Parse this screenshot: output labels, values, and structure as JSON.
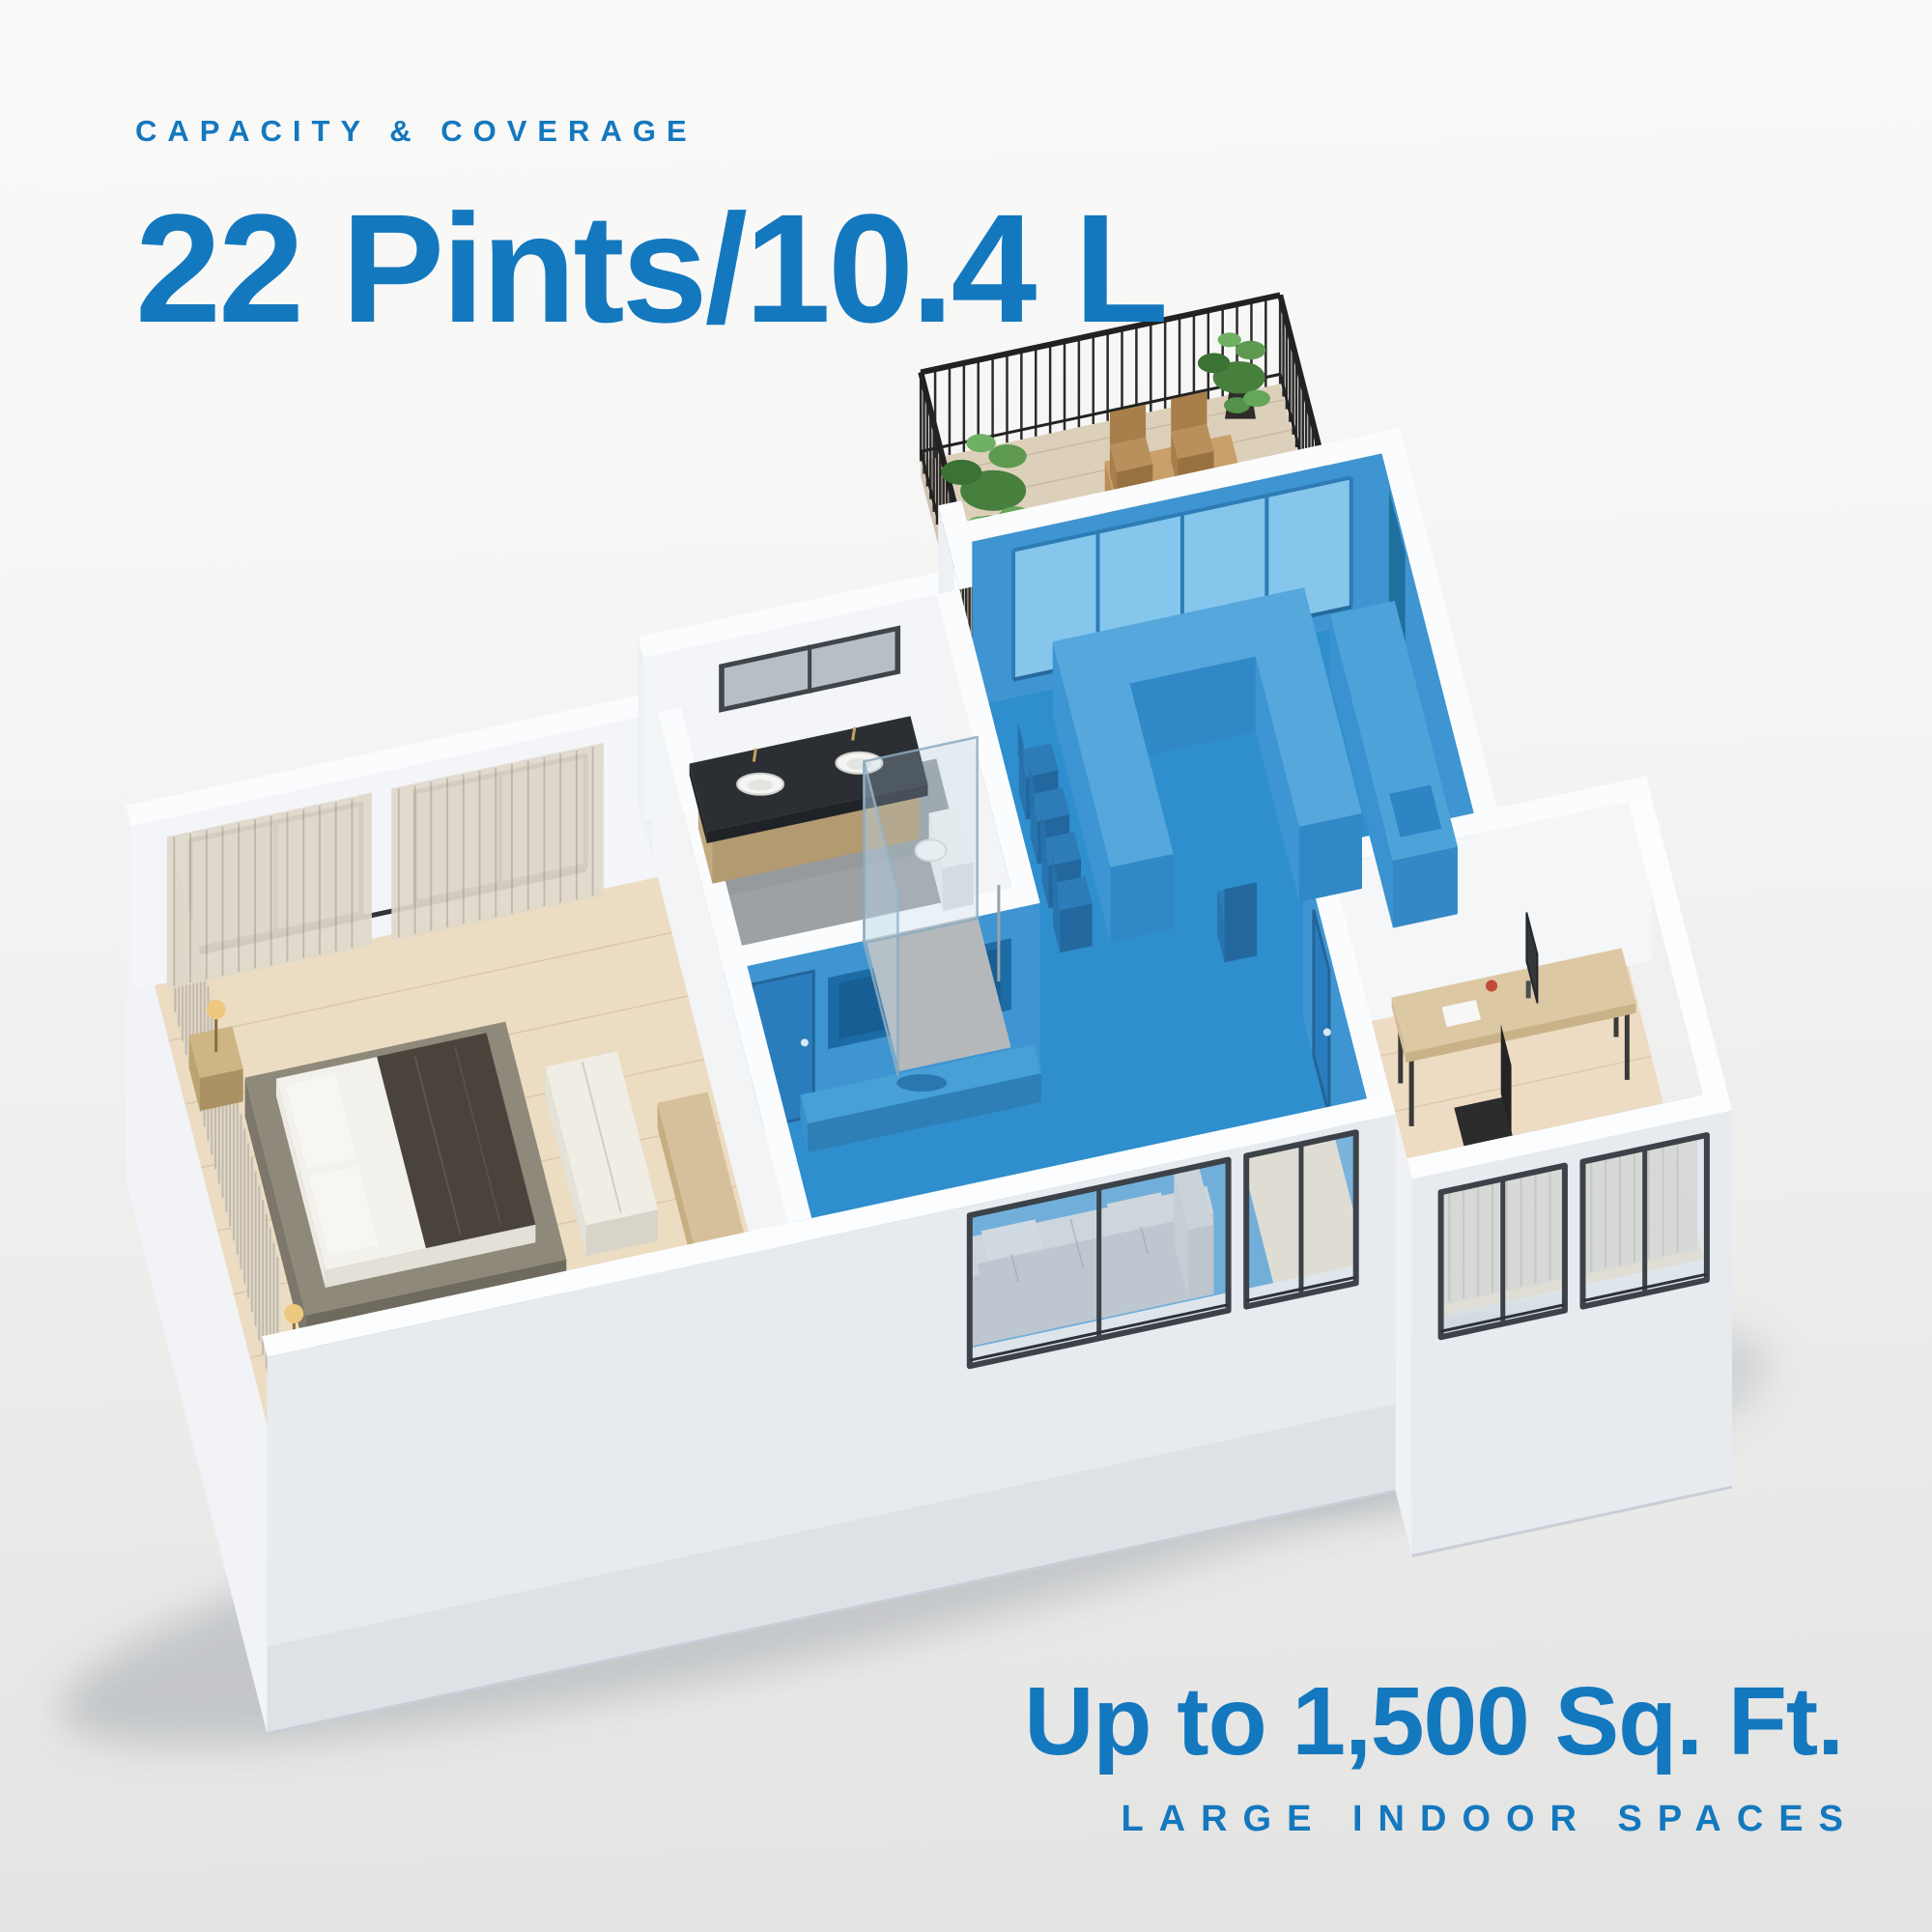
{
  "header": {
    "eyebrow": "CAPACITY & COVERAGE",
    "title": "22 Pints/10.4 L"
  },
  "coverage": {
    "headline": "Up to 1,500 Sq. Ft.",
    "subheadline": "LARGE INDOOR SPACES"
  },
  "colors": {
    "accent_blue": "#1478be",
    "coverage_highlight_floor": "#2f8ecd",
    "coverage_highlight_wall": "#3e95d1"
  },
  "scene": {
    "type": "isometric-3d-floor-plan",
    "highlighted_area": "kitchen, dining and living areas shaded blue to show dehumidifier coverage",
    "rooms": [
      "balcony terrace",
      "kitchen & dining",
      "bathroom",
      "bedroom",
      "living room",
      "entry hall",
      "home office"
    ]
  }
}
